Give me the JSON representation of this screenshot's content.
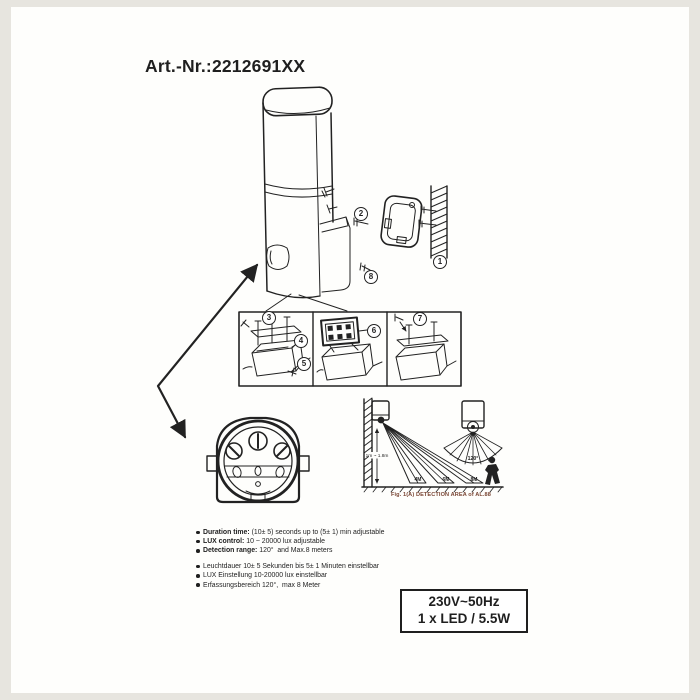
{
  "page": {
    "title": "Art.-Nr.:2212691XX"
  },
  "diagram": {
    "callouts": [
      "1",
      "2",
      "3",
      "4",
      "5",
      "6",
      "7",
      "8"
    ],
    "detection": {
      "height_label": "1m ~ 1.8m",
      "angle_label": "120°",
      "distances": [
        "4M",
        "6M",
        "8M"
      ],
      "caption": "Fig. 1(A) DETECTION AREA of AL.88",
      "caption_color": "#7a4634"
    }
  },
  "specs": {
    "bullets_en": [
      {
        "label": "Duration time:",
        "rest": " (10± 5) seconds up to (5± 1) min adjustable"
      },
      {
        "label": "LUX control:",
        "rest": " 10 ~ 20000 lux adjustable"
      },
      {
        "label": "Detection range:",
        "rest": " 120°  and Max.8 meters"
      }
    ],
    "bullets_de": [
      "Leuchtdauer 10± 5 Sekunden bis 5± 1 Minuten einstellbar",
      "LUX Einstellung 10-20000 lux einstellbar",
      "Erfassungsbereich 120°,  max 8 Meter"
    ],
    "power_box": {
      "line1": "230V~50Hz",
      "line2": "1 x LED / 5.5W"
    }
  },
  "colors": {
    "ink": "#1f1f1f",
    "paper": "#fefefc",
    "margin": "#e7e5df"
  }
}
